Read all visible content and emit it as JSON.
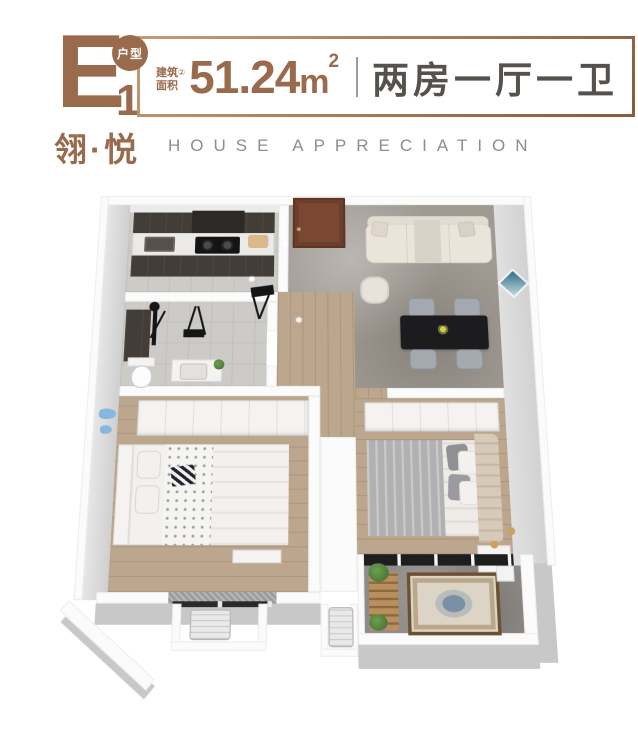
{
  "header": {
    "unit_letter": "E",
    "unit_number": "1",
    "unit_badge": "户型",
    "area_label_line1": "建筑",
    "area_label_line2": "面积",
    "area_footnote": "②",
    "area_value": "51.24",
    "area_unit": "m",
    "area_exponent": "2",
    "layout_text": "两房一厅一卫",
    "brand_cn": "翎·悦",
    "brand_en": "HOUSE APPRECIATION"
  },
  "colors": {
    "accent": "#9a6a4d",
    "border_dark": "#8a5a3c",
    "border_light": "#c59b74",
    "layout_gray": "#55524e",
    "brand_en_gray": "#8d8d8d",
    "wall_white": "#fbfbfb",
    "wall_face": "#d9d9d9",
    "floor_marble": "#a09a93",
    "floor_wood": "#bca68d",
    "floor_tile": "#cdcbc7",
    "floor_stone": "#8e8b88",
    "cabinet_dark": "#433d38",
    "door_brown": "#7a4832",
    "sofa_cream": "#eae5db",
    "table_black": "#1c1c1e",
    "chair_gray": "#a4a9b0",
    "bed_white": "#f3f1ed",
    "duvet_gray": "#b1b0b2",
    "headboard_beige": "#d8cab9",
    "wardrobe_white": "#f4f3f1",
    "plant_green": "#4d7a3c",
    "rug_border": "#6b5133",
    "rug_field": "#dcd4c5",
    "rug_medallion": "#7b90a6",
    "decor_blue": "#85b8dc",
    "gold": "#c9a25e"
  }
}
